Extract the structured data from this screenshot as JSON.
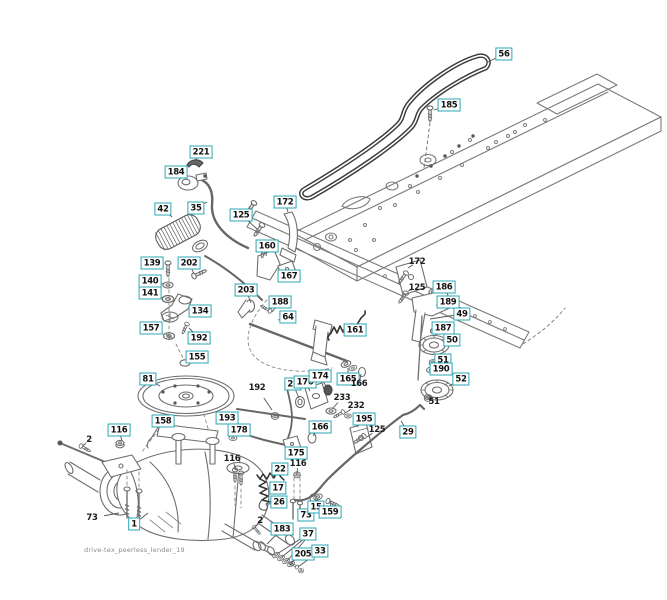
{
  "diagram": {
    "footer_text": "drive-tex_peerless_lender_19",
    "accent_color": "#2aa7b5",
    "line_color": "#555555",
    "callouts": [
      {
        "label": "56",
        "x": 504,
        "y": 54,
        "tx": 488,
        "ty": 62,
        "boxed": true
      },
      {
        "label": "185",
        "x": 449,
        "y": 105,
        "tx": 434,
        "ty": 110,
        "boxed": true
      },
      {
        "label": "221",
        "x": 201,
        "y": 152,
        "tx": 194,
        "ty": 162,
        "boxed": true
      },
      {
        "label": "184",
        "x": 176,
        "y": 172,
        "tx": 181,
        "ty": 178,
        "boxed": true
      },
      {
        "label": "42",
        "x": 163,
        "y": 209,
        "tx": 172,
        "ty": 217,
        "boxed": true
      },
      {
        "label": "35",
        "x": 196,
        "y": 208,
        "tx": 207,
        "ty": 202,
        "boxed": true
      },
      {
        "label": "125",
        "x": 241,
        "y": 215,
        "tx": 251,
        "ty": 209,
        "boxed": true
      },
      {
        "label": "172",
        "x": 285,
        "y": 202,
        "tx": 288,
        "ty": 212,
        "boxed": true
      },
      {
        "label": "160",
        "x": 267,
        "y": 246,
        "tx": 266,
        "ty": 256,
        "boxed": true
      },
      {
        "label": "167",
        "x": 289,
        "y": 276,
        "tx": 282,
        "ty": 270,
        "boxed": true
      },
      {
        "label": "203",
        "x": 246,
        "y": 290,
        "tx": 251,
        "ty": 303,
        "boxed": true
      },
      {
        "label": "188",
        "x": 280,
        "y": 302,
        "tx": 272,
        "ty": 312,
        "boxed": true
      },
      {
        "label": "64",
        "x": 288,
        "y": 317,
        "tx": 278,
        "ty": 320,
        "boxed": true
      },
      {
        "label": "161",
        "x": 355,
        "y": 330,
        "tx": 348,
        "ty": 326,
        "boxed": true
      },
      {
        "label": "139",
        "x": 152,
        "y": 263,
        "tx": 164,
        "ty": 267,
        "boxed": true
      },
      {
        "label": "202",
        "x": 189,
        "y": 263,
        "tx": 194,
        "ty": 274,
        "boxed": true
      },
      {
        "label": "140",
        "x": 150,
        "y": 281,
        "tx": 163,
        "ty": 284,
        "boxed": true
      },
      {
        "label": "141",
        "x": 150,
        "y": 293,
        "tx": 163,
        "ty": 298,
        "boxed": true
      },
      {
        "label": "134",
        "x": 200,
        "y": 311,
        "tx": 191,
        "ty": 305,
        "boxed": true
      },
      {
        "label": "157",
        "x": 151,
        "y": 328,
        "tx": 163,
        "ty": 334,
        "boxed": true
      },
      {
        "label": "192",
        "x": 199,
        "y": 338,
        "tx": 189,
        "ty": 328,
        "boxed": true
      },
      {
        "label": "155",
        "x": 197,
        "y": 357,
        "tx": 188,
        "ty": 362,
        "boxed": true
      },
      {
        "label": "81",
        "x": 148,
        "y": 379,
        "tx": 160,
        "ty": 386,
        "boxed": true
      },
      {
        "label": "158",
        "x": 163,
        "y": 421,
        "tx": 171,
        "ty": 427,
        "boxed": true
      },
      {
        "label": "193",
        "x": 227,
        "y": 418,
        "tx": 231,
        "ty": 426,
        "boxed": true
      },
      {
        "label": "178",
        "x": 239,
        "y": 430,
        "tx": 249,
        "ty": 436,
        "boxed": true
      },
      {
        "label": "23",
        "x": 293,
        "y": 384,
        "tx": 299,
        "ty": 398,
        "boxed": true
      },
      {
        "label": "176",
        "x": 305,
        "y": 382,
        "tx": 310,
        "ty": 391,
        "boxed": true
      },
      {
        "label": "174",
        "x": 320,
        "y": 376,
        "tx": 327,
        "ty": 388,
        "boxed": true
      },
      {
        "label": "165",
        "x": 348,
        "y": 379,
        "tx": 348,
        "ty": 368,
        "boxed": true
      },
      {
        "label": "166",
        "x": 320,
        "y": 427,
        "tx": 313,
        "ty": 436,
        "boxed": true
      },
      {
        "label": "195",
        "x": 364,
        "y": 419,
        "tx": 357,
        "ty": 427,
        "boxed": true
      },
      {
        "label": "29",
        "x": 408,
        "y": 432,
        "tx": 401,
        "ty": 421,
        "boxed": true
      },
      {
        "label": "116",
        "x": 119,
        "y": 430,
        "tx": 122,
        "ty": 441,
        "boxed": true
      },
      {
        "label": "1",
        "x": 134,
        "y": 524,
        "tx": 148,
        "ty": 513,
        "boxed": true
      },
      {
        "label": "175",
        "x": 296,
        "y": 453,
        "tx": 290,
        "ty": 448,
        "boxed": true
      },
      {
        "label": "22",
        "x": 280,
        "y": 469,
        "tx": 272,
        "ty": 478,
        "boxed": true
      },
      {
        "label": "17",
        "x": 278,
        "y": 488,
        "tx": 269,
        "ty": 488,
        "boxed": true
      },
      {
        "label": "26",
        "x": 279,
        "y": 502,
        "tx": 269,
        "ty": 504,
        "boxed": true
      },
      {
        "label": "183",
        "x": 282,
        "y": 529,
        "tx": 267,
        "ty": 544,
        "boxed": true
      },
      {
        "label": "37",
        "x": 308,
        "y": 534,
        "tx": 277,
        "ty": 554,
        "boxed": true
      },
      {
        "label": "205",
        "x": 303,
        "y": 554,
        "tx": 291,
        "ty": 563,
        "boxed": true
      },
      {
        "label": "33",
        "x": 320,
        "y": 551,
        "tx": 298,
        "ty": 567,
        "boxed": true
      },
      {
        "label": "73",
        "x": 306,
        "y": 515,
        "tx": 301,
        "ty": 511,
        "boxed": true
      },
      {
        "label": "15",
        "x": 316,
        "y": 507,
        "tx": 318,
        "ty": 499,
        "boxed": true
      },
      {
        "label": "159",
        "x": 330,
        "y": 512,
        "tx": 331,
        "ty": 501,
        "boxed": true
      },
      {
        "label": "186",
        "x": 444,
        "y": 287,
        "tx": 436,
        "ty": 291,
        "boxed": true
      },
      {
        "label": "189",
        "x": 448,
        "y": 302,
        "tx": 436,
        "ty": 305,
        "boxed": true
      },
      {
        "label": "49",
        "x": 462,
        "y": 314,
        "tx": 430,
        "ty": 319,
        "boxed": true
      },
      {
        "label": "187",
        "x": 443,
        "y": 328,
        "tx": 437,
        "ty": 331,
        "boxed": true
      },
      {
        "label": "50",
        "x": 452,
        "y": 340,
        "tx": 446,
        "ty": 344,
        "boxed": true
      },
      {
        "label": "51",
        "x": 443,
        "y": 360,
        "tx": 436,
        "ty": 362,
        "boxed": true
      },
      {
        "label": "190",
        "x": 441,
        "y": 369,
        "tx": 434,
        "ty": 370,
        "boxed": true
      },
      {
        "label": "52",
        "x": 461,
        "y": 379,
        "tx": 449,
        "ty": 386,
        "boxed": true
      },
      {
        "label": "172",
        "x": 417,
        "y": 262,
        "tx": 408,
        "ty": 268,
        "boxed": false
      },
      {
        "label": "125",
        "x": 417,
        "y": 288,
        "tx": 408,
        "ty": 291,
        "boxed": false
      },
      {
        "label": "125",
        "x": 377,
        "y": 430,
        "tx": 367,
        "ty": 437,
        "boxed": false
      },
      {
        "label": "233",
        "x": 342,
        "y": 398,
        "tx": 333,
        "ty": 408,
        "boxed": false
      },
      {
        "label": "232",
        "x": 356,
        "y": 406,
        "tx": 345,
        "ty": 413,
        "boxed": false
      },
      {
        "label": "166",
        "x": 359,
        "y": 384,
        "tx": 361,
        "ty": 374,
        "boxed": false
      },
      {
        "label": "51",
        "x": 434,
        "y": 402,
        "tx": 430,
        "ty": 396,
        "boxed": false
      },
      {
        "label": "192",
        "x": 257,
        "y": 388,
        "tx": 272,
        "ty": 410,
        "boxed": false
      },
      {
        "label": "116",
        "x": 232,
        "y": 459,
        "tx": 236,
        "ty": 469,
        "boxed": false
      },
      {
        "label": "116",
        "x": 298,
        "y": 464,
        "tx": 297,
        "ty": 473,
        "boxed": false
      },
      {
        "label": "2",
        "x": 89,
        "y": 440,
        "tx": 83,
        "ty": 446,
        "boxed": false
      },
      {
        "label": "2",
        "x": 260,
        "y": 521,
        "tx": 256,
        "ty": 526,
        "boxed": false
      },
      {
        "label": "73",
        "x": 92,
        "y": 518,
        "tx": 119,
        "ty": 513,
        "boxed": false
      }
    ]
  }
}
